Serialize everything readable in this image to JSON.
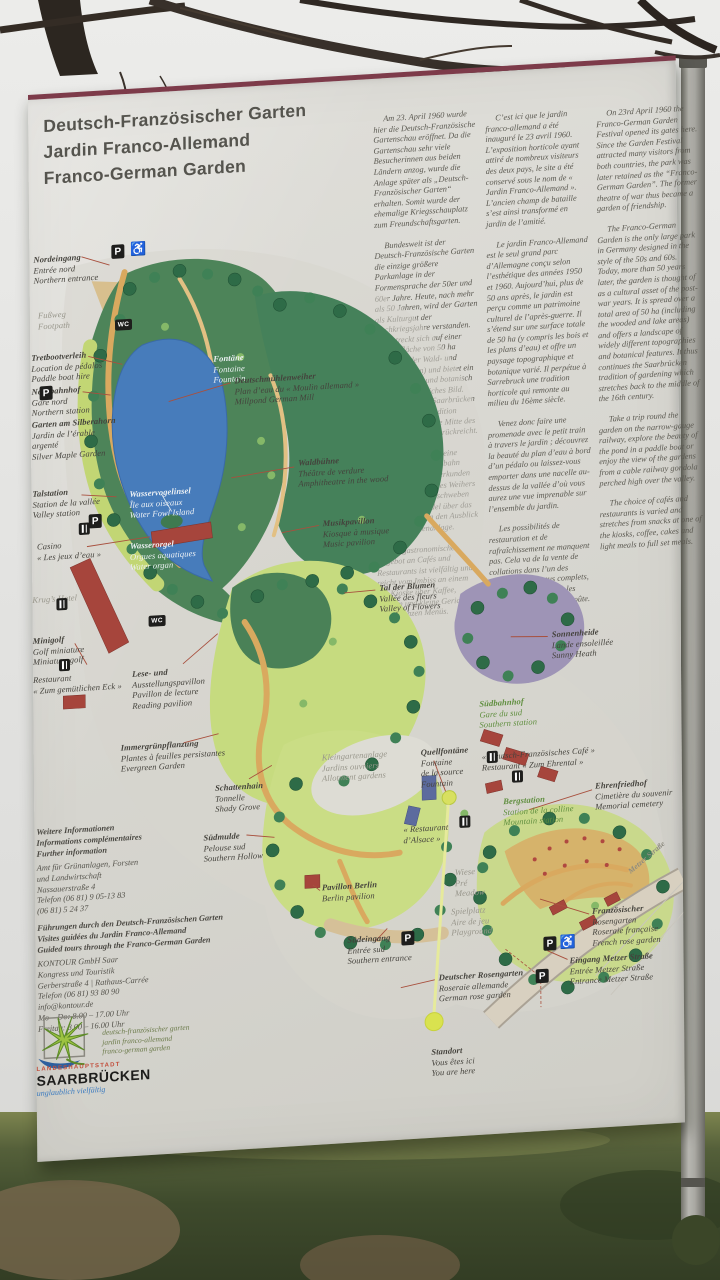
{
  "board": {
    "title": "Deutsch-Französischer Garten\nJardin Franco-Allemand\nFranco-German Garden",
    "columns": {
      "de": [
        "Am 23. April 1960 wurde hier die Deutsch-Französische Gartenschau eröffnet. Da die Gartenschau sehr viele Besucherinnen aus beiden Ländern anzog, wurde die Anlage später als „Deutsch-Französischer Garten“ erhalten. Somit wurde der ehemalige Kriegsschauplatz zum Freundschaftsgarten.",
        "Bundesweit ist der Deutsch-Französische Garten die einzige größere Parkanlage in der Formensprache der 50er und 60er Jahre. Heute, nach mehr als 50 Jahren, wird der Garten als Kulturgut der Nachkriegsjahre verstanden. Er erstreckt sich auf einer Gesamtfläche von 50 ha (inklusive der Wald- und Wasserflächen) und bietet ein topographisch und botanisch abwechslungsreiches Bild. Somit führt er in Saarbrücken eine Gartenbautradition weiter, die bis in die Mitte des 16. Jahrhunderts zurückreicht.",
        "Drehen Sie doch eine Runde mit der Kleinbahn durch den Garten, erkunden Sie die Schönheit des Weihers per Tretboot oder schweben Sie in einer Gondel über das Tal und genießen den Ausblick über die Gartenanlage.",
        "Das gastronomische Angebot an Cafés und Restaurants ist vielfältig und reicht vom Imbiss an einem der Kioske über Kaffee, Kuchen und kleine Gerichte bis zu ganzen Menüs."
      ],
      "fr": [
        "C’est ici que le jardin franco-allemand a été inauguré le 23 avril 1960. L’exposition horticole ayant attiré de nombreux visiteurs des deux pays, le site a été conservé sous le nom de « Jardin Franco-Allemand ». L’ancien champ de bataille s’est ainsi transformé en jardin de l’amitié.",
        "Le jardin Franco-Allemand est le seul grand parc d’Allemagne conçu selon l’esthétique des années 1950 et 1960. Aujourd’hui, plus de 50 ans après, le jardin est perçu comme un patrimoine culturel de l’après-guerre. Il s’étend sur une surface totale de 50 ha (y compris les bois et les plans d’eau) et offre un paysage topographique et botanique varié. Il perpétue à Sarrebruck une tradition horticole qui remonte au milieu du 16ème siècle.",
        "Venez donc faire une promenade avec le petit train à travers le jardin ; découvrez la beauté du plan d’eau à bord d’un pédalo ou laissez-vous emporter dans une nacelle au-dessus de la vallée d’où vous aurez une vue imprenable sur l’ensemble du jardin.",
        "Les possibilités de restauration et de rafraîchissement ne manquent pas. Cela va de la vente de collations dans l’un des kiosques aux menus complets, en passant par le café, les pâtisseries et les casse-croûte."
      ],
      "en": [
        "On 23rd April 1960 the Franco-German Garden Festival opened its gates here. Since the Garden Festival attracted many visitors from both countries, the park was later retained as the “Franco-German Garden”. The former theatre of war thus became a garden of friendship.",
        "The Franco-German Garden is the only large park in Germany designed in the style of the 50s and 60s. Today, more than 50 years later, the garden is thought of as a cultural asset of the post-war years. It is spread over a total area of 50 ha (including the wooded and lake areas) and offers a landscape of widely different topographies and botanical features. It thus continues the Saarbrücken tradition of gardening which stretches back to the middle of the 16th century.",
        "Take a trip round the garden on the narrow-gauge railway, explore the beauty of the pond in a paddle boat or enjoy the view of the gardens from a cable railway gondola perched high over the valley.",
        "The choice of cafés and restaurants is varied and stretches from snacks at one of the kiosks, coffee, cakes and light meals to full set meals."
      ]
    },
    "map": {
      "labels": {
        "nordeingang": "Nordeingang\nEntrée nord\nNorthern entrance",
        "fussweg": "Fußweg\nFootpath",
        "tretboot": "Tretbootverleih\nLocation de pédalos\nPaddle boat hire",
        "nordbahnhof": "Nordbahnhof\nGare nord\nNorthern station",
        "silberahorn": "Garten am Silberahorn\nJardin de l’érable\nargenté\nSilver Maple Garden",
        "talstation": "Talstation\nStation de la vallée\nValley station",
        "casino": "Casino\n« Les jeux d’eau »",
        "krugs_hotel": "Krug’s Hotel",
        "minigolf": "Minigolf\nGolf miniature\nMiniature golf",
        "restaurant_eck": "Restaurant\n« Zum gemütlichen Eck »",
        "fontaine": "Fontäne\nFontaine\nFountain",
        "wasservogelinsel": "Wasservogelinsel\nÎle aux oiseaux\nWater Fowl Island",
        "wasserorgel": "Wasserorgel\nOrgues aquatiques\nWater organ",
        "deutschmuehlenweiher": "Deutschmühlenweiher\nPlan d’eau du « Moulin allemand »\nMillpond German Mill",
        "waldbuehne": "Waldbühne\nThéâtre de verdure\nAmphitheatre in the wood",
        "musikpavillon": "Musikpavillon\nKiosque à musique\nMusic pavilion",
        "tal_der_blumen": "Tal der Blumen\nVallée des fleurs\nValley of Flowers",
        "sonnenheide": "Sonnenheide\nLande ensoleillée\nSunny Heath",
        "suedbahnhof": "Südbahnhof\nGare du sud\nSouthern station",
        "lesepavillon": "Lese- und\nAusstellungspavillon\nPavillon de lecture\nReading pavilion",
        "immergruen": "Immergrünpflanzung\nPlantes à feuilles persistantes\nEvergreen Garden",
        "kleingarten": "Kleingartenanlage\nJardins ouvriers\nAllotment gardens",
        "quellfontaene": "Quellfontäne\nFontaine\nde la source\nFountain",
        "schattenhain": "Schattenhain\nTonnelle\nShady Grove",
        "suedmulde": "Südmulde\nPelouse sud\nSouthern Hollow",
        "cafe_ehrental": "« Deutsch-Französisches Café »\nRestaurant « Zum Ehrental »",
        "ehrenfriedhof": "Ehrenfriedhof\nCimetière du souvenir\nMemorial cemetery",
        "bergstation": "Bergstation\nStation de la colline\nMountain station",
        "restaurant_alsace": "« Restaurant\nd’Alsace »",
        "pavillon_berlin": "Pavillon Berlin\nBerlin pavilion",
        "wiese": "Wiese\nPré\nMeadow",
        "spielplatz": "Spielplatz\nAire de jeu\nPlayground",
        "suedeingang": "Südeingang\nEntrée sud\nSouthern entrance",
        "deutscher_rosengarten": "Deutscher Rosengarten\nRoseraie allemande\nGerman rose garden",
        "franz_rosengarten": "Französischer Rosengarten\nRoseraie française\nFrench rose garden",
        "eingang_metzer": "Eingang Metzer Straße\nEntrée Metzer Straße\nEntrance Metzer Straße",
        "standort": "Standort\nVous êtes ici\nYou are here",
        "metzer_road": "Metzer Straße"
      }
    },
    "icons": {
      "parking": "P",
      "wc": "WC",
      "wheelchair": "♿"
    },
    "info": {
      "heading": "Weitere Informationen\nInformations complémentaires\nFurther information",
      "amt": "Amt für Grünanlagen, Forsten\nund Landwirtschaft\nNassauerstraße 4\nTelefon (06 81) 9 05-13 83\n(06 81) 5 24 37",
      "tours": "Führungen durch den Deutsch-Französischen Garten\nVisites guidées du Jardin Franco-Allemand\nGuided tours through the Franco-German Garden",
      "kontour": "KONTOUR GmbH Saar\nKongress und Touristik\nGerberstraße 4 | Rathaus-Carrée\nTelefon (06 81) 93 80 90\ninfo@kontour.de\nMo – Do: 8.00 – 17.00 Uhr\nFreitag: 8.00 – 16.00 Uhr"
    },
    "logos": {
      "garden_script": "deutsch-französischer garten\njardin franco-allemand\nfranco-german garden",
      "city_small": "LANDESHAUPTSTADT",
      "city_name": "SAARBRÜCKEN",
      "city_tag": "unglaublich vielfältig"
    },
    "colors": {
      "accent_maroon": "#7d3b4a",
      "leader_red": "#a8503e",
      "lake_blue": "#477cbb",
      "forest_green": "#3f8156",
      "lawn_green": "#c6db7f",
      "path_tan": "#d9a95f",
      "heath_purple": "#9e94b6",
      "marker_yellow": "#d9e24f"
    }
  }
}
